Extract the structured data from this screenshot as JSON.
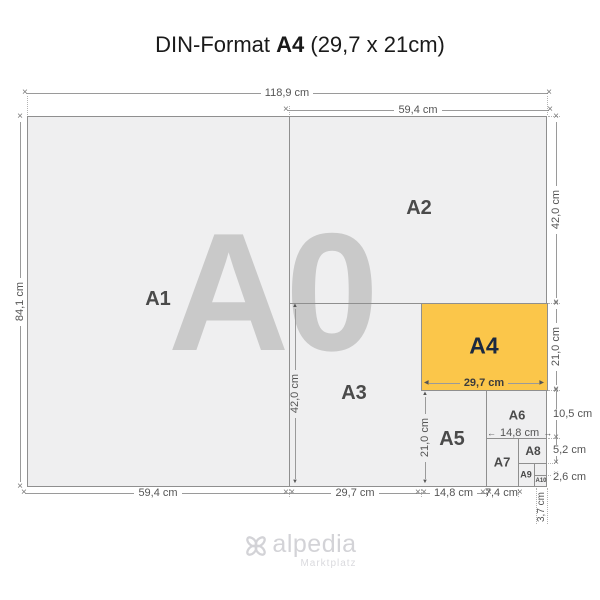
{
  "title": {
    "prefix": "DIN-Format",
    "format": "A4",
    "suffix": "(29,7 x 21cm)"
  },
  "watermark": "A0",
  "formats": {
    "a1": "A1",
    "a2": "A2",
    "a3": "A3",
    "a4": "A4",
    "a5": "A5",
    "a6": "A6",
    "a7": "A7",
    "a8": "A8",
    "a9": "A9",
    "a10": "A10"
  },
  "dims": {
    "top_full": "118,9 cm",
    "top_half": "59,4 cm",
    "left_full": "84,1 cm",
    "right_a2_height": "42,0 cm",
    "right_a4_height": "21,0 cm",
    "a4_width": "29,7 cm",
    "a3_height": "42,0 cm",
    "a5_height": "21,0 cm",
    "a6_width": "14,8 cm",
    "right_a6_height": "10,5 cm",
    "right_a8_height": "5,2 cm",
    "right_a10_height": "2,6 cm",
    "bottom_a1_width": "59,4 cm",
    "bottom_a3_width": "29,7 cm",
    "bottom_a5_width": "14,8 cm",
    "bottom_a7_width": "7,4 cm",
    "a9_width": "3,7 cm"
  },
  "logo": {
    "name": "alpedia",
    "tagline": "Marktplatz"
  },
  "colors": {
    "a4_fill": "#fbc64a",
    "a4_text": "#1b2940",
    "paper_fill": "#efeff0",
    "outline": "#8f8f8f",
    "watermark": "#c9c9c9",
    "label": "#4a4a4a",
    "dim_text": "#555555",
    "logo": "#d3d3d7"
  }
}
